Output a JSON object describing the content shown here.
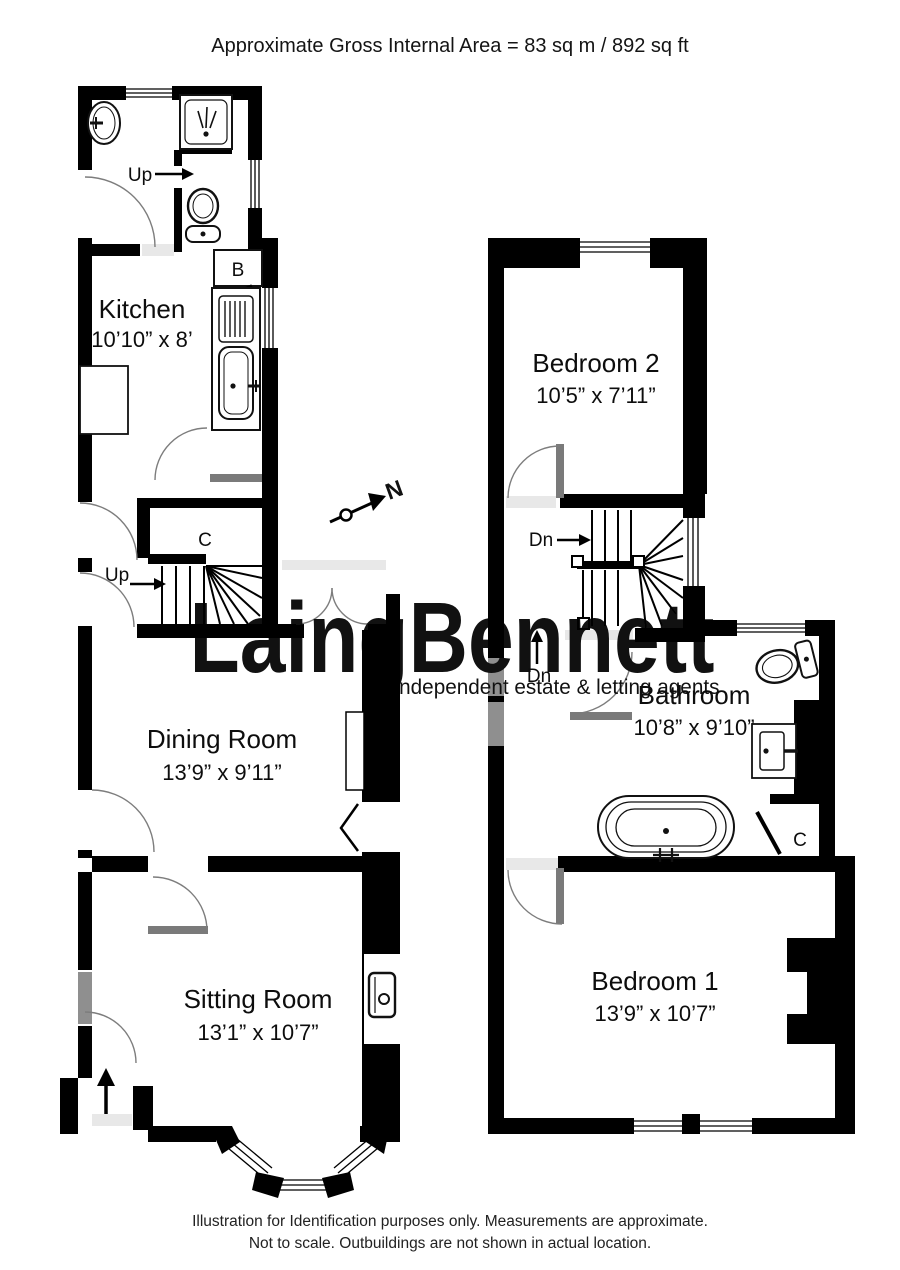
{
  "title": "Approximate Gross Internal Area =  83 sq m / 892 sq ft",
  "watermark": {
    "brand": "LaingBennett",
    "tagline": "independent estate & letting agents",
    "color": "#d8e2dc"
  },
  "compass": {
    "north_label": "N"
  },
  "ground_floor": {
    "kitchen": {
      "name": "Kitchen",
      "dims": "10’10” x 8’"
    },
    "dining_room": {
      "name": "Dining Room",
      "dims": "13’9” x 9’11”"
    },
    "sitting_room": {
      "name": "Sitting Room",
      "dims": "13’1” x 10’7”"
    },
    "up_steps_label": "Up",
    "up_stairs_label": "Up",
    "cupboard_label": "C",
    "boiler_label": "B"
  },
  "first_floor": {
    "bedroom_2": {
      "name": "Bedroom 2",
      "dims": "10’5” x 7’11”"
    },
    "bathroom": {
      "name": "Bathroom",
      "dims": "10’8” x 9’10”"
    },
    "bedroom_1": {
      "name": "Bedroom 1",
      "dims": "13’9” x 10’7”"
    },
    "dn_stairs_label": "Dn",
    "dn_landing_label": "Dn",
    "cupboard_label": "C"
  },
  "footer": {
    "line1": "Illustration for Identification purposes only.  Measurements are approximate.",
    "line2": "Not to scale.  Outbuildings are not shown in actual location."
  },
  "colors": {
    "wall": "#000000",
    "door_arc": "#7d7d7d",
    "watermark": "#d8e2dc"
  }
}
